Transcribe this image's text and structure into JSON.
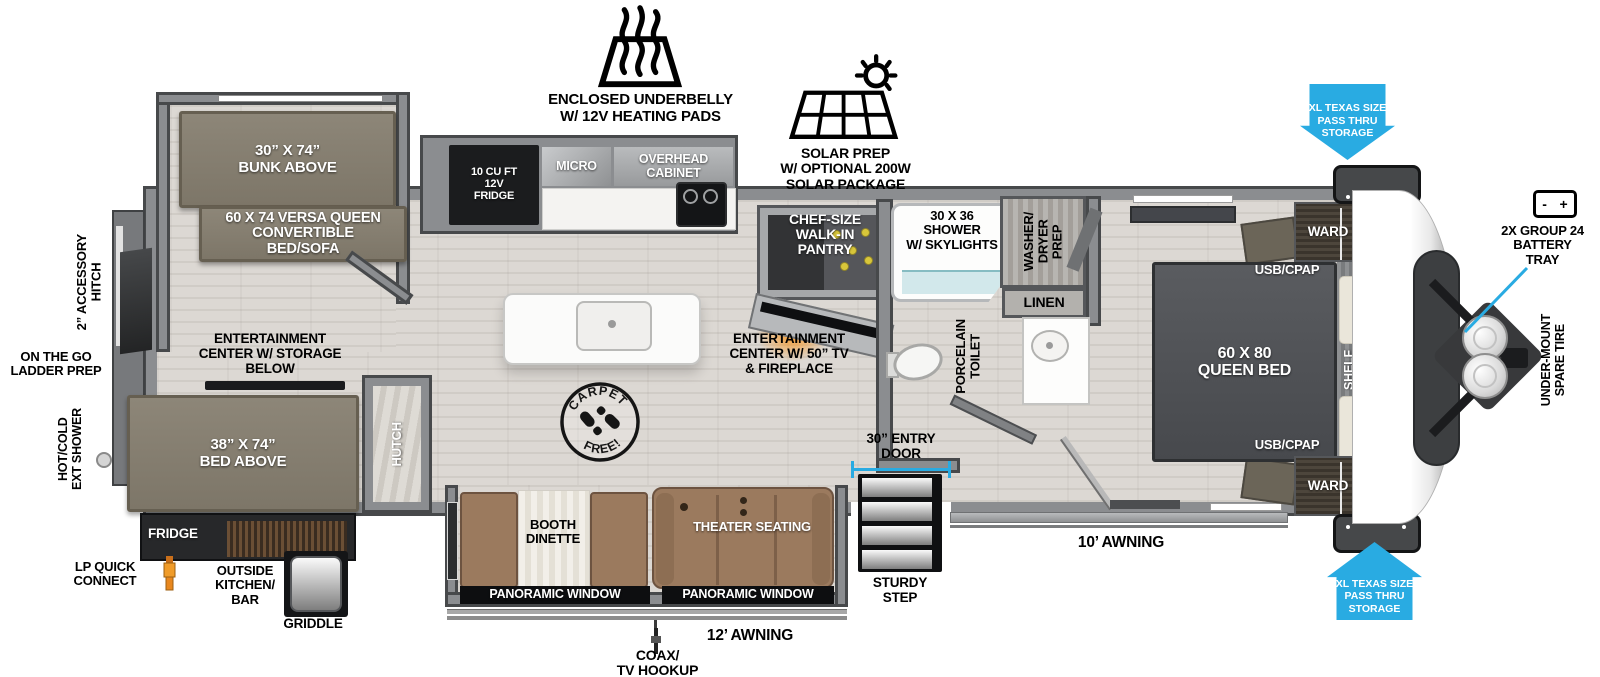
{
  "colors": {
    "accent_blue": "#29abe2",
    "wall_gray": "#8b8d90",
    "bed_taupe": "#857f71",
    "sofa_brown": "#9b7a5e",
    "fire_orange": "#f7941d",
    "lp_orange": "#e8871e"
  },
  "exterior": {
    "underbelly": "ENCLOSED UNDERBELLY\nW/ 12V HEATING PADS",
    "solar": "SOLAR PREP\nW/ OPTIONAL 200W\nSOLAR PACKAGE",
    "pass_thru_top": "XL TEXAS SIZE\nPASS THRU\nSTORAGE",
    "pass_thru_bottom": "XL TEXAS SIZE\nPASS THRU\nSTORAGE",
    "battery_tray": "2X GROUP 24\nBATTERY\nTRAY",
    "battery_minus": "-",
    "battery_plus": "+",
    "spare_tire": "UNDER-MOUNT\nSPARE TIRE",
    "accessory_hitch": "2” ACCESSORY\nHITCH",
    "ladder_prep": "ON THE GO\nLADDER PREP",
    "ext_shower": "HOT/COLD\nEXT SHOWER",
    "lp_quick_connect": "LP QUICK\nCONNECT",
    "outside_kitchen": "OUTSIDE\nKITCHEN/\nBAR",
    "griddle": "GRIDDLE",
    "coax": "COAX/\nTV HOOKUP",
    "awning_12": "12’ AWNING",
    "awning_10": "10’ AWNING",
    "entry_door": "30” ENTRY\nDOOR",
    "sturdy_step": "STURDY\nSTEP"
  },
  "rear_bedroom": {
    "bunk": "30” X 74”\nBUNK ABOVE",
    "versa_queen": "60 X 74 VERSA QUEEN\nCONVERTIBLE\nBED/SOFA",
    "ent_center": "ENTERTAINMENT\nCENTER W/ STORAGE\nBELOW",
    "bed": "38” X 74”\nBED ABOVE",
    "hutch": "HUTCH",
    "fridge": "FRIDGE"
  },
  "kitchen": {
    "fridge": "10 CU FT\n12V\nFRIDGE",
    "micro": "MICRO",
    "overhead_cabinet": "OVERHEAD\nCABINET",
    "pantry": "CHEF-SIZE\nWALK-IN\nPANTRY",
    "carpet_top": "CARPET",
    "carpet_bottom": "FREE!"
  },
  "living": {
    "ent_center": "ENTERTAINMENT\nCENTER W/ 50” TV\n& FIREPLACE",
    "booth_dinette": "BOOTH\nDINETTE",
    "theater": "THEATER SEATING",
    "panoramic_1": "PANORAMIC WINDOW",
    "panoramic_2": "PANORAMIC WINDOW"
  },
  "bathroom": {
    "shower": "30 X 36\nSHOWER\nW/ SKYLIGHTS",
    "washer_dryer": "WASHER/\nDRYER\nPREP",
    "linen": "LINEN",
    "toilet": "PORCELAIN\nTOILET"
  },
  "front_bedroom": {
    "queen_bed": "60 X 80\nQUEEN BED",
    "usb_top": "USB/CPAP",
    "usb_bottom": "USB/CPAP",
    "ward_top": "WARD",
    "ward_bottom": "WARD",
    "shelf": "SHELF"
  }
}
